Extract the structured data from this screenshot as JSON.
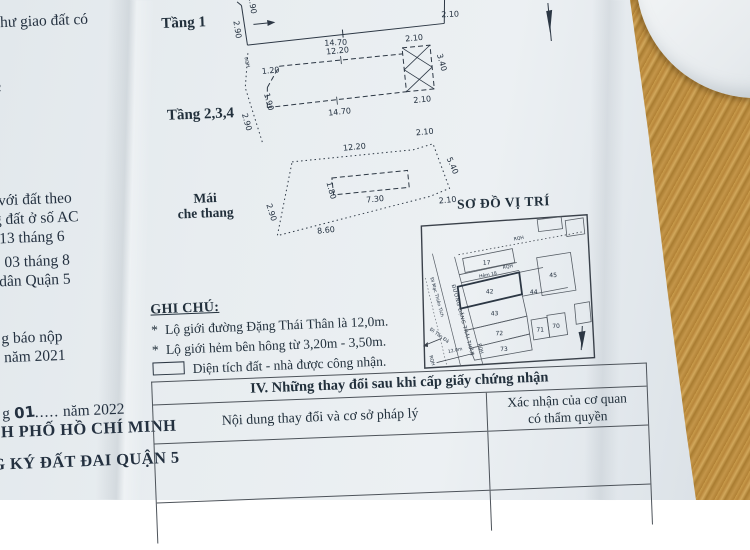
{
  "margin": {
    "l1": "Ở như giao đất có",
    "l2": "2",
    "l3": "với đất theo",
    "l4": "g đất ở số AC",
    "l5": "y 13 tháng 6",
    "l6": "03 tháng 8",
    "l7": "dân Quận 5",
    "l8": "g báo nộp",
    "l9": "năm 2021",
    "l10a": "g",
    "l10b": "01",
    "l10dots": ".....",
    "l10c": "năm 2022",
    "l11": "H PHỐ HỒ CHÍ MINH",
    "l12": "G KÝ ĐẤT ĐAI QUẬN 5"
  },
  "compass": {
    "north": "B"
  },
  "plans": {
    "tang1": {
      "label": "Tầng 1",
      "left": "2.90",
      "top_left": "1.90",
      "bottom": "14.70",
      "right": "2.10"
    },
    "tang234": {
      "label": "Tầng 2,3,4",
      "top": "12.20",
      "balcony_top": "2.10",
      "balcony_right": "3.40",
      "balcony_bottom": "2.10",
      "bottom": "14.70",
      "left_vertical": "1.90",
      "left_slant": "1.20",
      "outer_boundary": "2.90",
      "boundary_label": "RQH"
    },
    "mai": {
      "label_line1": "Mái",
      "label_line2": "che thang",
      "top": "12.20",
      "top_right": "2.10",
      "right": "5.40",
      "mid_right": "2.10",
      "bottom": "8.60",
      "left": "2.90",
      "inner_width": "7.30",
      "inner_height": "1.80"
    }
  },
  "site_map": {
    "title": "SƠ ĐỒ VỊ TRÍ",
    "street": "ĐƯỜNG ĐẶNG THÁI THÂN",
    "alley": "Hẻm 18",
    "direction_top": "Đi Mạc Thiên Tích",
    "direction_bottom": "Đi Tản Đà",
    "street_width": "12.0m",
    "boundary": "RQH",
    "lots": [
      "17",
      "42",
      "43",
      "44",
      "45",
      "70",
      "71",
      "72",
      "73"
    ]
  },
  "notes": {
    "heading": "GHI CHÚ:",
    "bullet": "*",
    "item1": "Lộ giới đường Đặng Thái Thân là 12,0m.",
    "item2": "Lộ giới hẻm bên hông từ 3,20m - 3,50m.",
    "legend": "Diện tích đất - nhà được công nhận."
  },
  "table": {
    "title": "IV. Những thay đổi sau khi cấp giấy chứng nhận",
    "col_left": "Nội dung thay đổi và cơ sở pháp lý",
    "col_right_line1": "Xác nhận của cơ quan",
    "col_right_line2": "có thẩm quyền"
  }
}
